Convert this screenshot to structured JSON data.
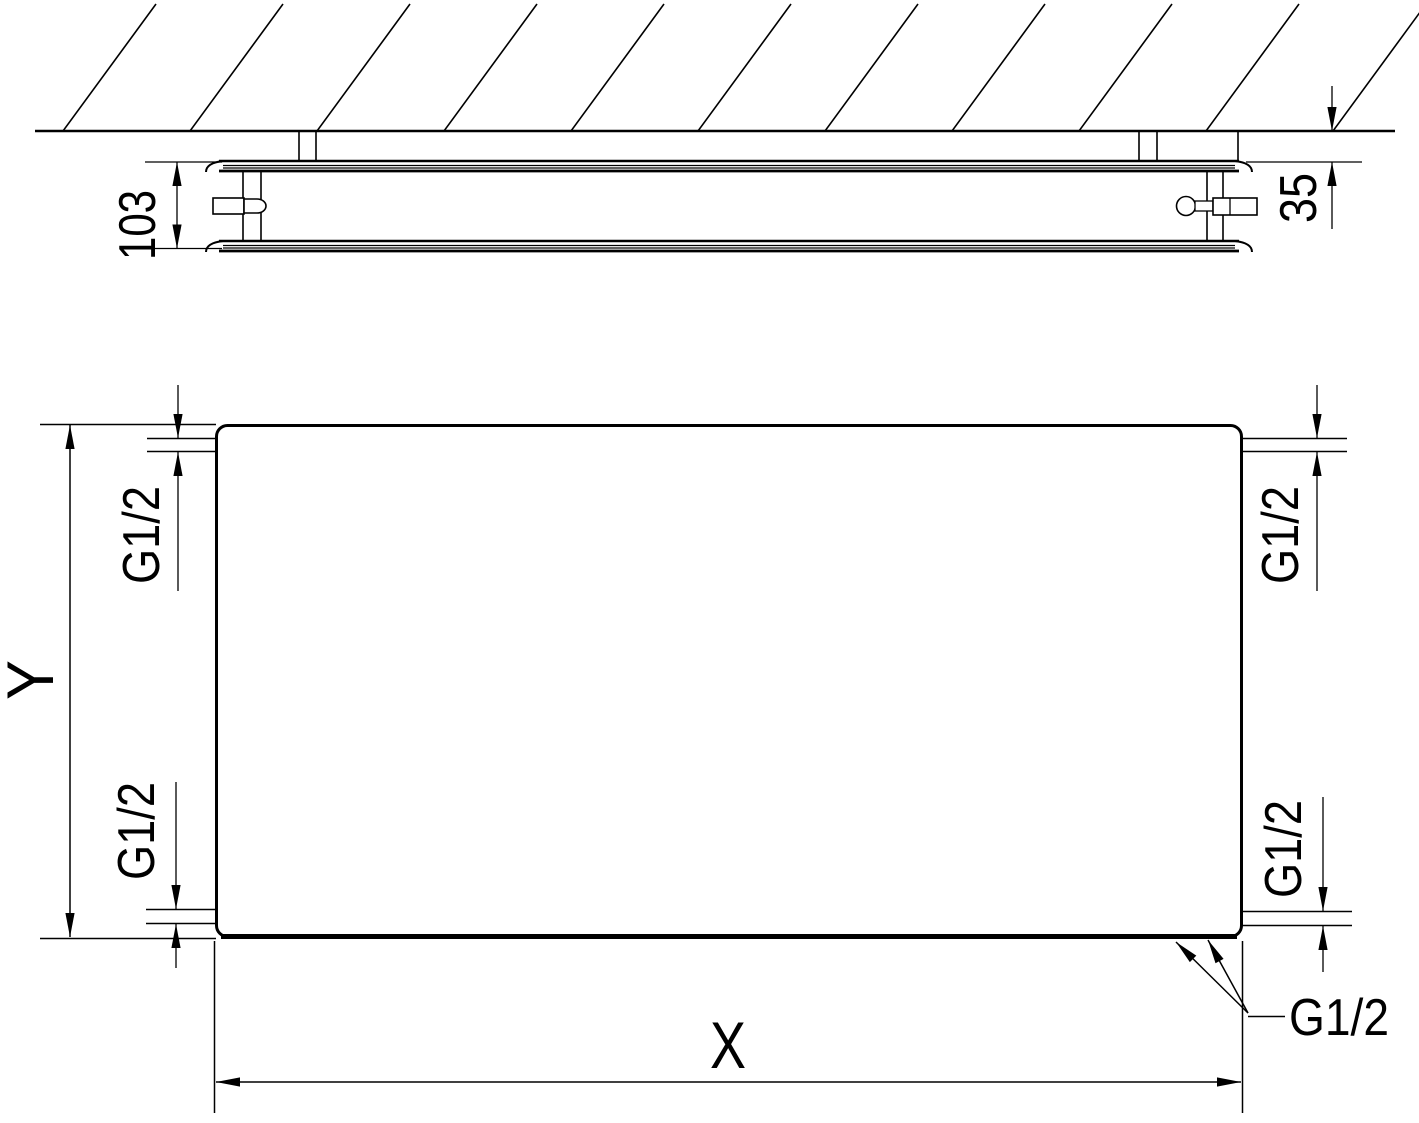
{
  "colors": {
    "ink": "#000000",
    "paper": "#ffffff"
  },
  "top_view": {
    "depth_label": "103",
    "wall_gap_label": "35"
  },
  "front_view": {
    "height_label": "Y",
    "width_label": "X",
    "port_top_left": "G1/2",
    "port_top_right": "G1/2",
    "port_bottom_left": "G1/2",
    "port_bottom_right": "G1/2",
    "port_callout": "G1/2"
  }
}
